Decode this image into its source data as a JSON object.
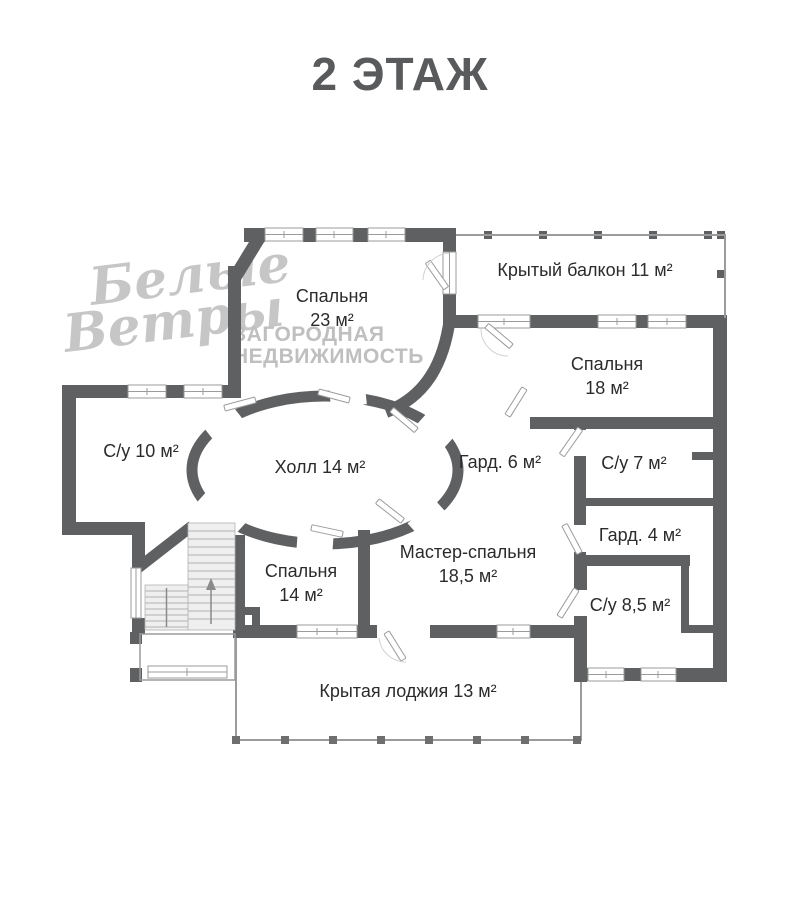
{
  "title": "2 ЭТАЖ",
  "watermark": {
    "logo_line1": "Белые",
    "logo_line2": "Ветры",
    "tagline_line1": "ЗАГОРОДНАЯ",
    "tagline_line2": "НЕДВИЖИМОСТЬ"
  },
  "rooms": {
    "bedroom23": {
      "name": "Спальня",
      "area": "23 м²"
    },
    "balcony": {
      "label": "Крытый балкон 11 м²"
    },
    "bedroom18": {
      "name": "Спальня",
      "area": "18 м²"
    },
    "bath10": {
      "label": "С/у 10 м²"
    },
    "hall": {
      "label": "Холл 14 м²"
    },
    "wardrobe6": {
      "label": "Гард. 6 м²"
    },
    "bath7": {
      "label": "С/у 7 м²"
    },
    "wardrobe4": {
      "label": "Гард. 4 м²"
    },
    "master": {
      "name": "Мастер-спальня",
      "area": "18,5 м²"
    },
    "bedroom14": {
      "name": "Спальня",
      "area": "14 м²"
    },
    "bath85": {
      "label": "С/у 8,5 м²"
    },
    "loggia": {
      "label": "Крытая лоджия 13 м²"
    }
  },
  "colors": {
    "wall": "#5f6062",
    "railing": "#9b9b9b",
    "window_line": "#9b9b9b",
    "step_line": "#b2b2b2",
    "text": "#2b2b2b",
    "title": "#595a5c",
    "watermark": "#c6c6c6"
  }
}
